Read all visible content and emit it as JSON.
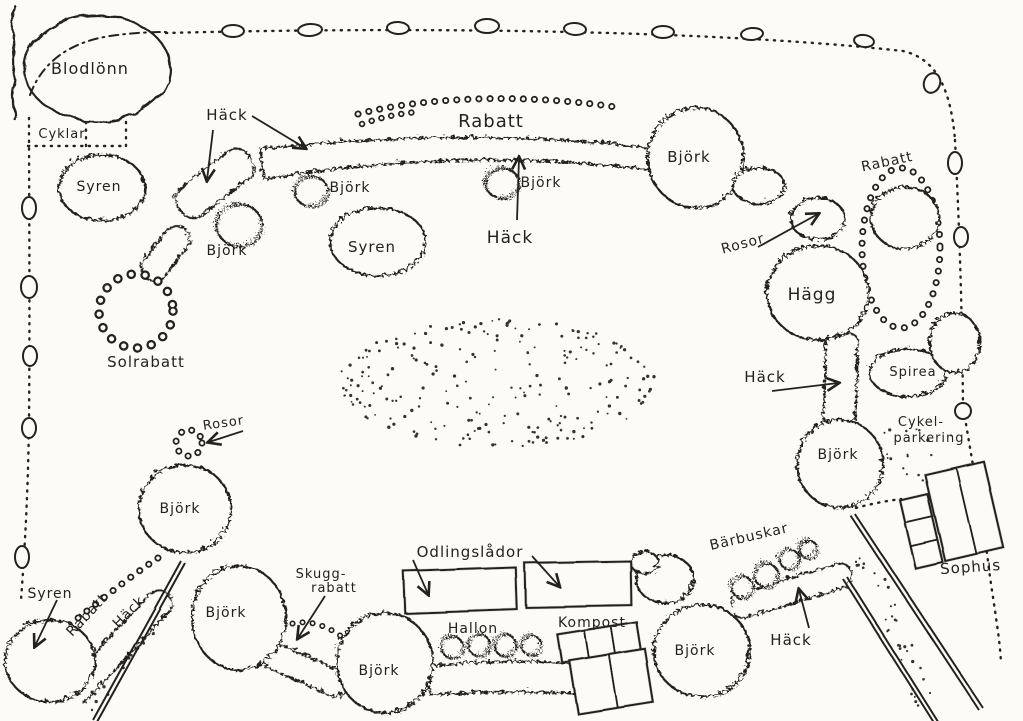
{
  "title": "Hand-drawn garden plan",
  "colors": {
    "ink": "#24221e",
    "paper": "#fcfbf8"
  },
  "labels": {
    "blodlonn": "Blodlönn",
    "cyklar": "Cyklar",
    "syren_top_left": "Syren",
    "hack_top_left": "Häck",
    "bjork_top_left_a": "Björk",
    "bjork_top_left_b": "Björk",
    "syren_top_mid": "Syren",
    "rabatt_top": "Rabatt",
    "hack_top_mid": "Häck",
    "bjork_mid": "Björk",
    "bjork_top_right": "Björk",
    "rabatt_right": "Rabatt",
    "rosor_right": "Rosor",
    "hagg": "Hägg",
    "hack_right": "Häck",
    "spirea": "Spirea",
    "cykelparkering_line1": "Cykel-",
    "cykelparkering_line2": "parkering",
    "bjork_right": "Björk",
    "sophus": "Sophus",
    "solrabatt": "Solrabatt",
    "rosor_bottom_left": "Rosor",
    "bjork_bottom_left_a": "Björk",
    "rabatt_bottom_left": "Rabatt",
    "hack_bottom_left": "Häck",
    "syren_bottom_left": "Syren",
    "bjork_bottom_left_b": "Björk",
    "skuggrabatt_line1": "Skugg-",
    "skuggrabatt_line2": "rabatt",
    "bjork_bottom_mid": "Björk",
    "odlingslador": "Odlingslådor",
    "hallon": "Hallon",
    "kompost": "Kompost",
    "bjork_bottom_right": "Björk",
    "barbuskar": "Bärbuskar",
    "hack_bottom_right": "Häck"
  }
}
